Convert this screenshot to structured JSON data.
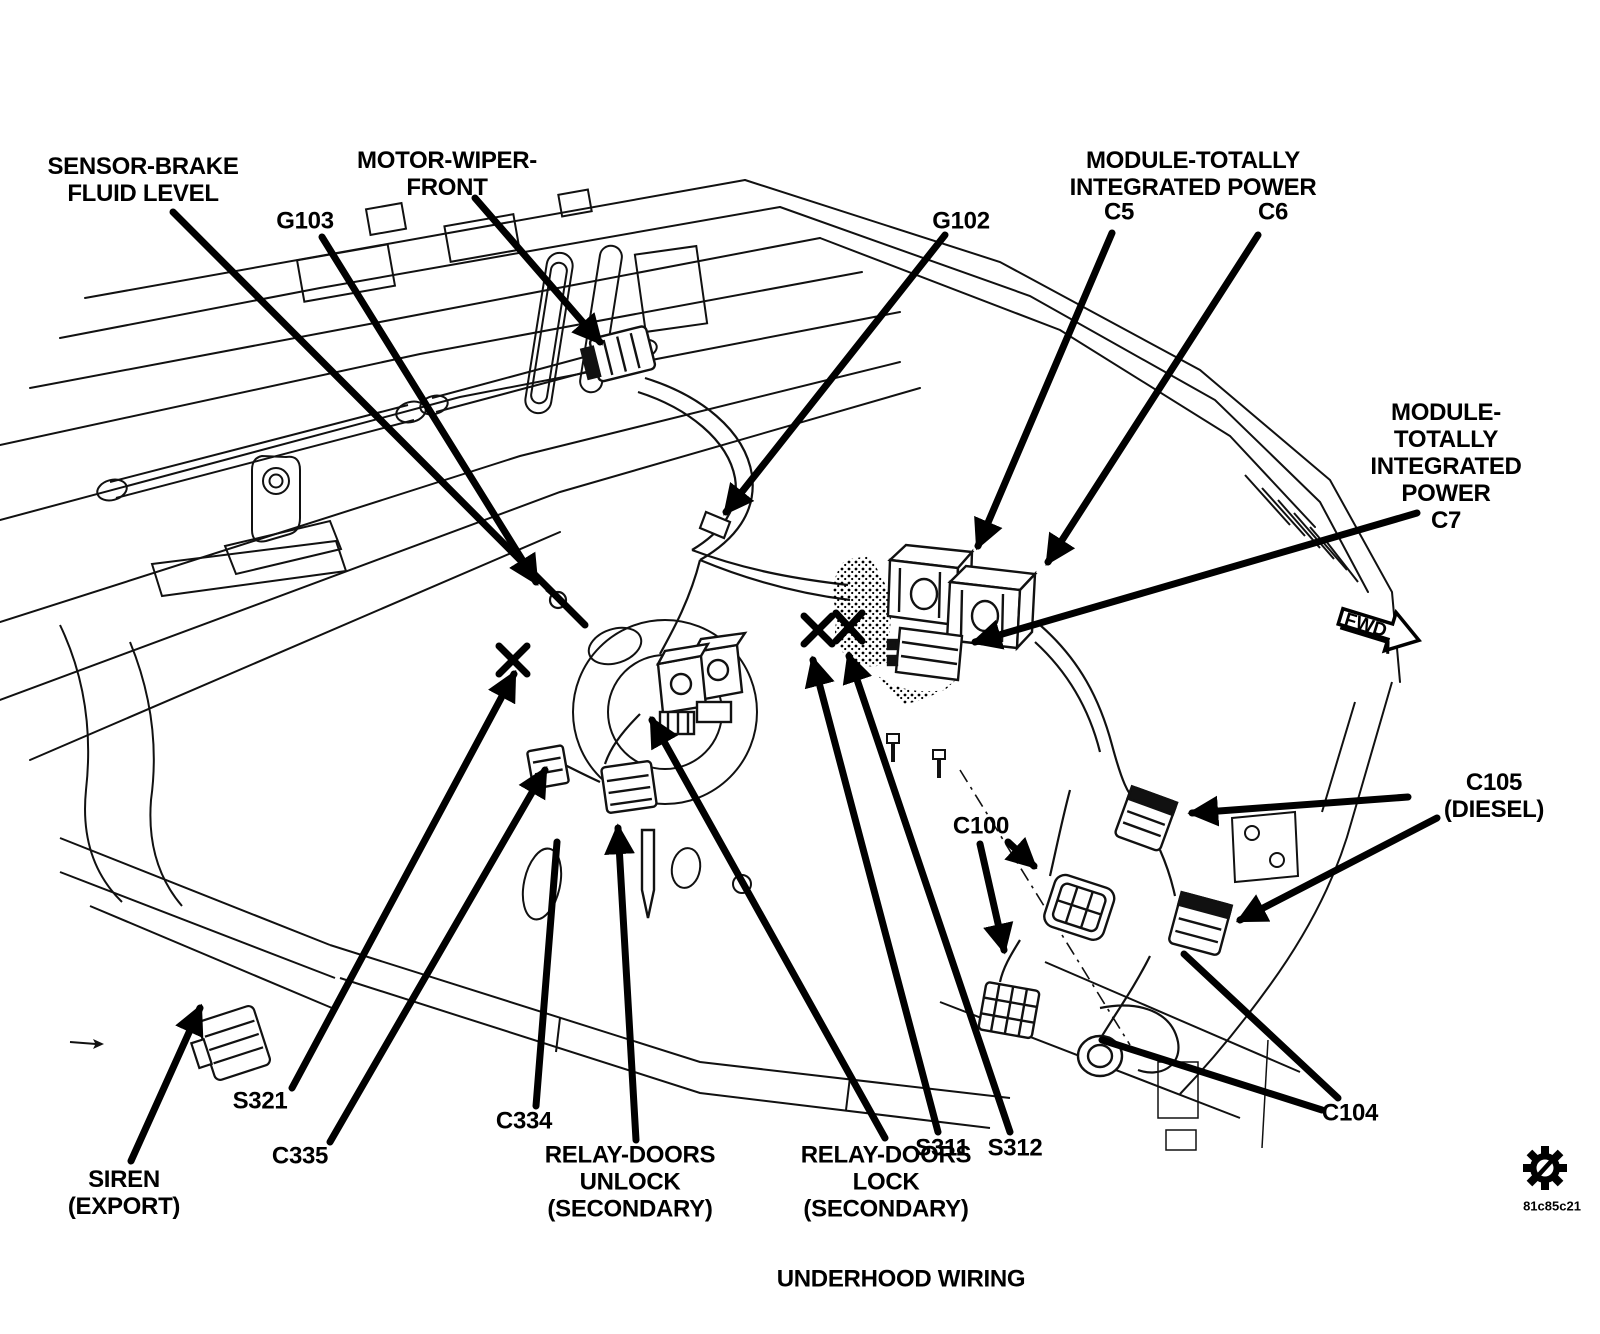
{
  "diagram": {
    "title": "UNDERHOOD WIRING",
    "figure_code": "81c85c21",
    "labels": {
      "sensor_brake": {
        "text": "SENSOR-BRAKE\nFLUID LEVEL"
      },
      "motor_wiper": {
        "text": "MOTOR-WIPER-\nFRONT"
      },
      "g103": {
        "text": "G103"
      },
      "g102": {
        "text": "G102"
      },
      "tipm_c5c6": {
        "text": "MODULE-TOTALLY\nINTEGRATED POWER"
      },
      "c5": {
        "text": "C5"
      },
      "c6": {
        "text": "C6"
      },
      "tipm_c7": {
        "text": "MODULE-TOTALLY\nINTEGRATED POWER\nC7"
      },
      "fwd": {
        "text": "FWD"
      },
      "c105": {
        "text": "C105 (DIESEL)"
      },
      "c100": {
        "text": "C100"
      },
      "c104": {
        "text": "C104"
      },
      "s321": {
        "text": "S321"
      },
      "c335": {
        "text": "C335"
      },
      "c334": {
        "text": "C334"
      },
      "siren": {
        "text": "SIREN\n(EXPORT)"
      },
      "relay_unlock": {
        "text": "RELAY-DOORS\nUNLOCK\n(SECONDARY)"
      },
      "relay_lock": {
        "text": "RELAY-DOORS\nLOCK\n(SECONDARY)"
      },
      "s311": {
        "text": "S311"
      },
      "s312": {
        "text": "S312"
      }
    },
    "colors": {
      "ink": "#000000",
      "paper": "#ffffff"
    }
  }
}
